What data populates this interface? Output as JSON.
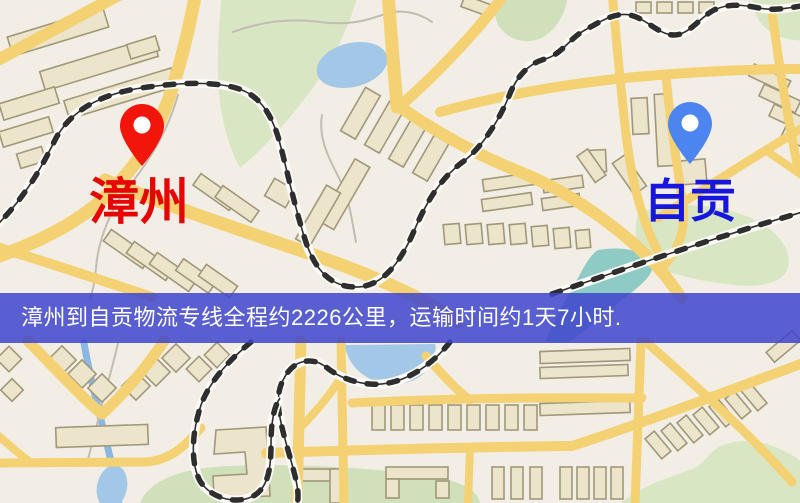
{
  "banner": {
    "text": "漳州到自贡物流专线全程约2226公里，运输时间约1天7小时.",
    "bg_color": "rgba(62,68,204,0.85)",
    "text_color": "#ffffff"
  },
  "markers": [
    {
      "id": "origin",
      "label": "漳州",
      "label_color": "#e60505",
      "pin_color": "#f2150a"
    },
    {
      "id": "destination",
      "label": "自贡",
      "label_color": "#1616dd",
      "pin_color": "#4d85f0"
    }
  ],
  "map": {
    "colors": {
      "background": "#f2eee5",
      "road": "#f4d173",
      "park": "#d9e6c3",
      "water": "#a3c7e6",
      "river": "#8ab8e2",
      "teal_water": "#8ecbc4",
      "building_fill": "#ece4cb",
      "building_stroke": "#a09878",
      "railway": "#2e2e2e"
    }
  }
}
